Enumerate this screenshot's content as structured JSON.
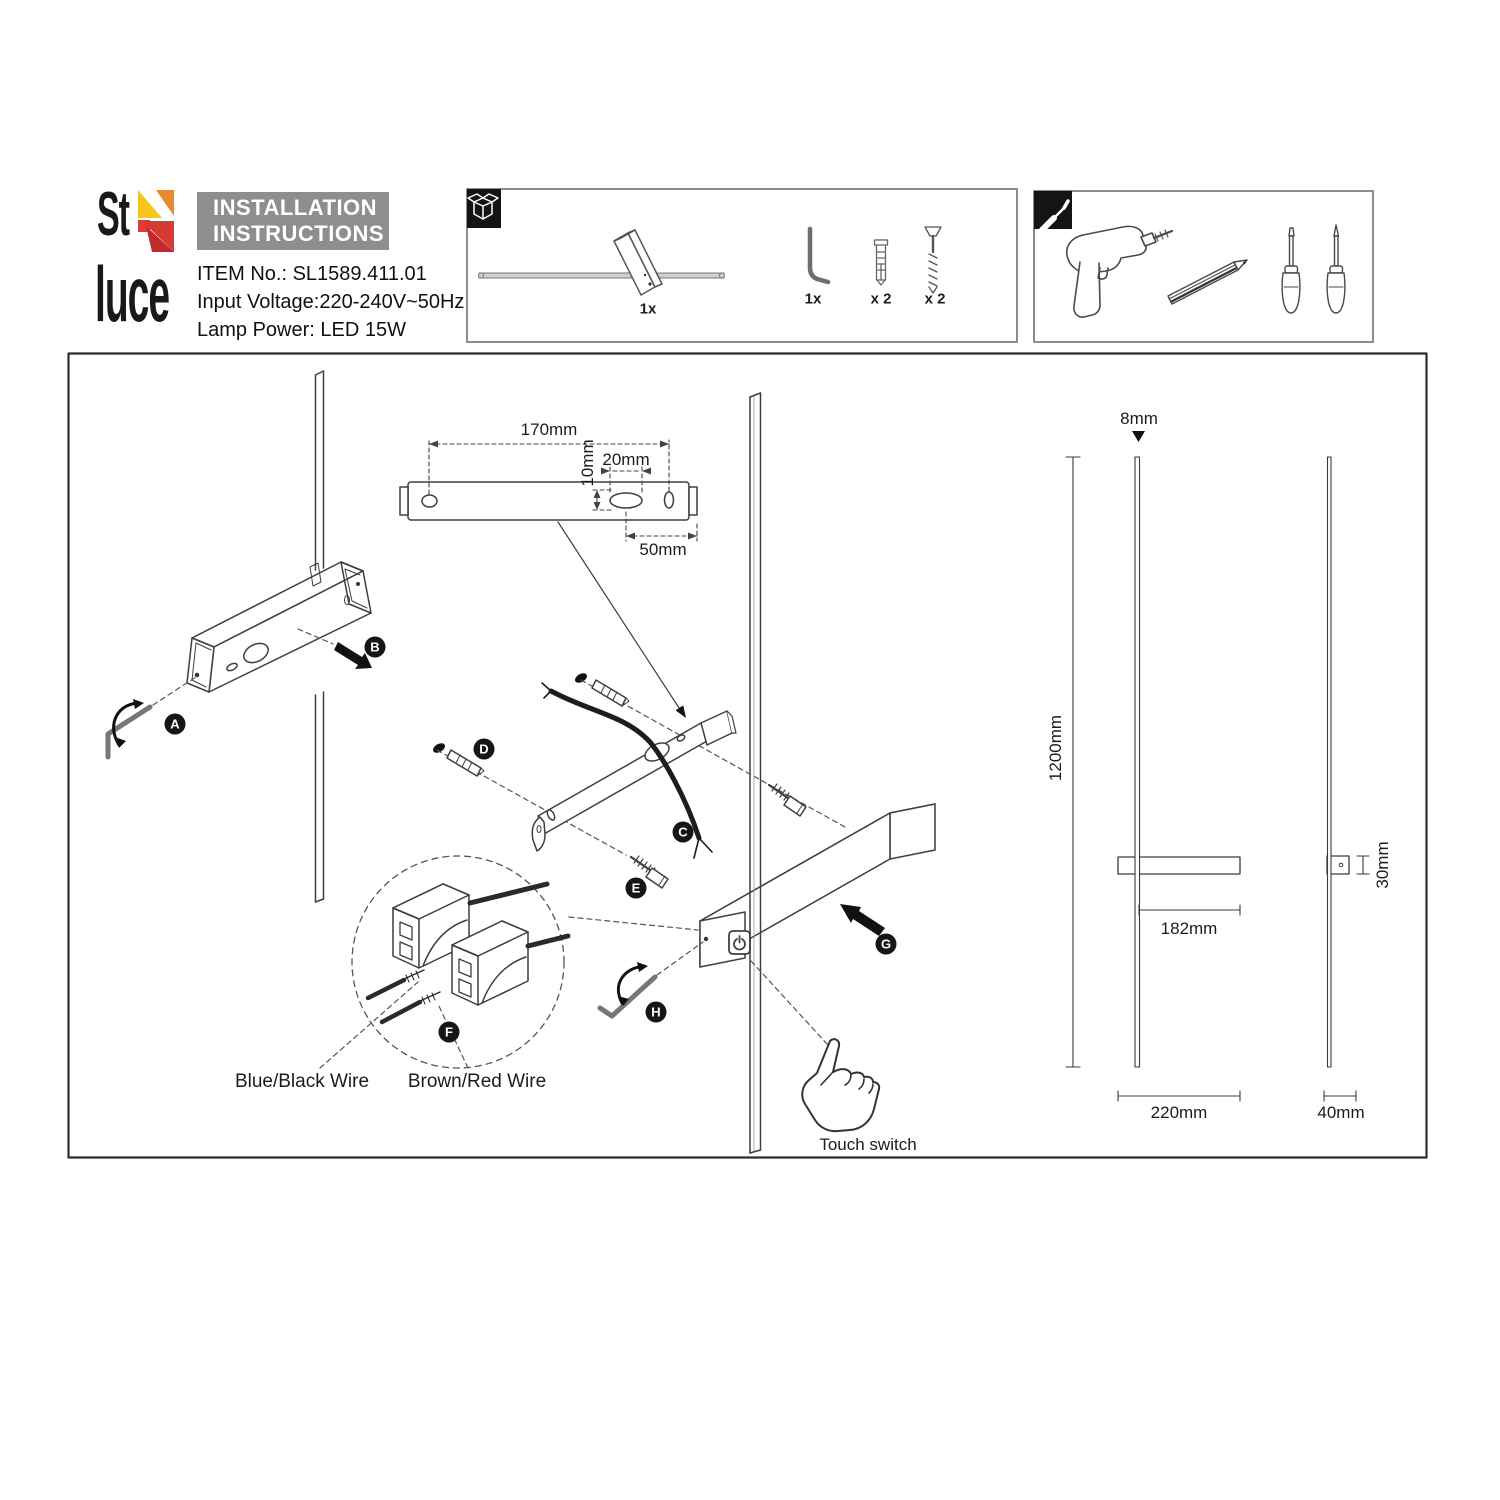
{
  "logo": {
    "top": "St",
    "bottom": "luce",
    "colors": {
      "yellow": "#f6c61f",
      "orange": "#e9882c",
      "red": "#e23c30",
      "dark_red": "#bf2b2e"
    }
  },
  "header": {
    "line1": "INSTALLATION",
    "line2": "INSTRUCTIONS",
    "bg": "#8e8e8e"
  },
  "info": {
    "item": "ITEM No.: SL1589.411.01",
    "voltage": "Input Voltage:220-240V~50Hz",
    "lamp": "Lamp Power: LED 15W"
  },
  "package": {
    "lamp_qty": "1x",
    "hex_key_qty": "1x",
    "anchor_qty": "x 2",
    "screw_qty": "x 2"
  },
  "steps": [
    "A",
    "B",
    "C",
    "D",
    "E",
    "F",
    "G",
    "H"
  ],
  "bracket_dims": {
    "length": "170mm",
    "offset": "10mm",
    "slot_width": "20mm",
    "right_offset": "50mm"
  },
  "product_dims": {
    "rod_diameter": "8mm",
    "height": "1200mm",
    "arm": "182mm",
    "depth": "30mm",
    "base_width": "220mm",
    "side_width": "40mm"
  },
  "wiring": {
    "blue_black": "Blue/Black Wire",
    "brown_red": "Brown/Red Wire"
  },
  "touch_label": "Touch switch"
}
